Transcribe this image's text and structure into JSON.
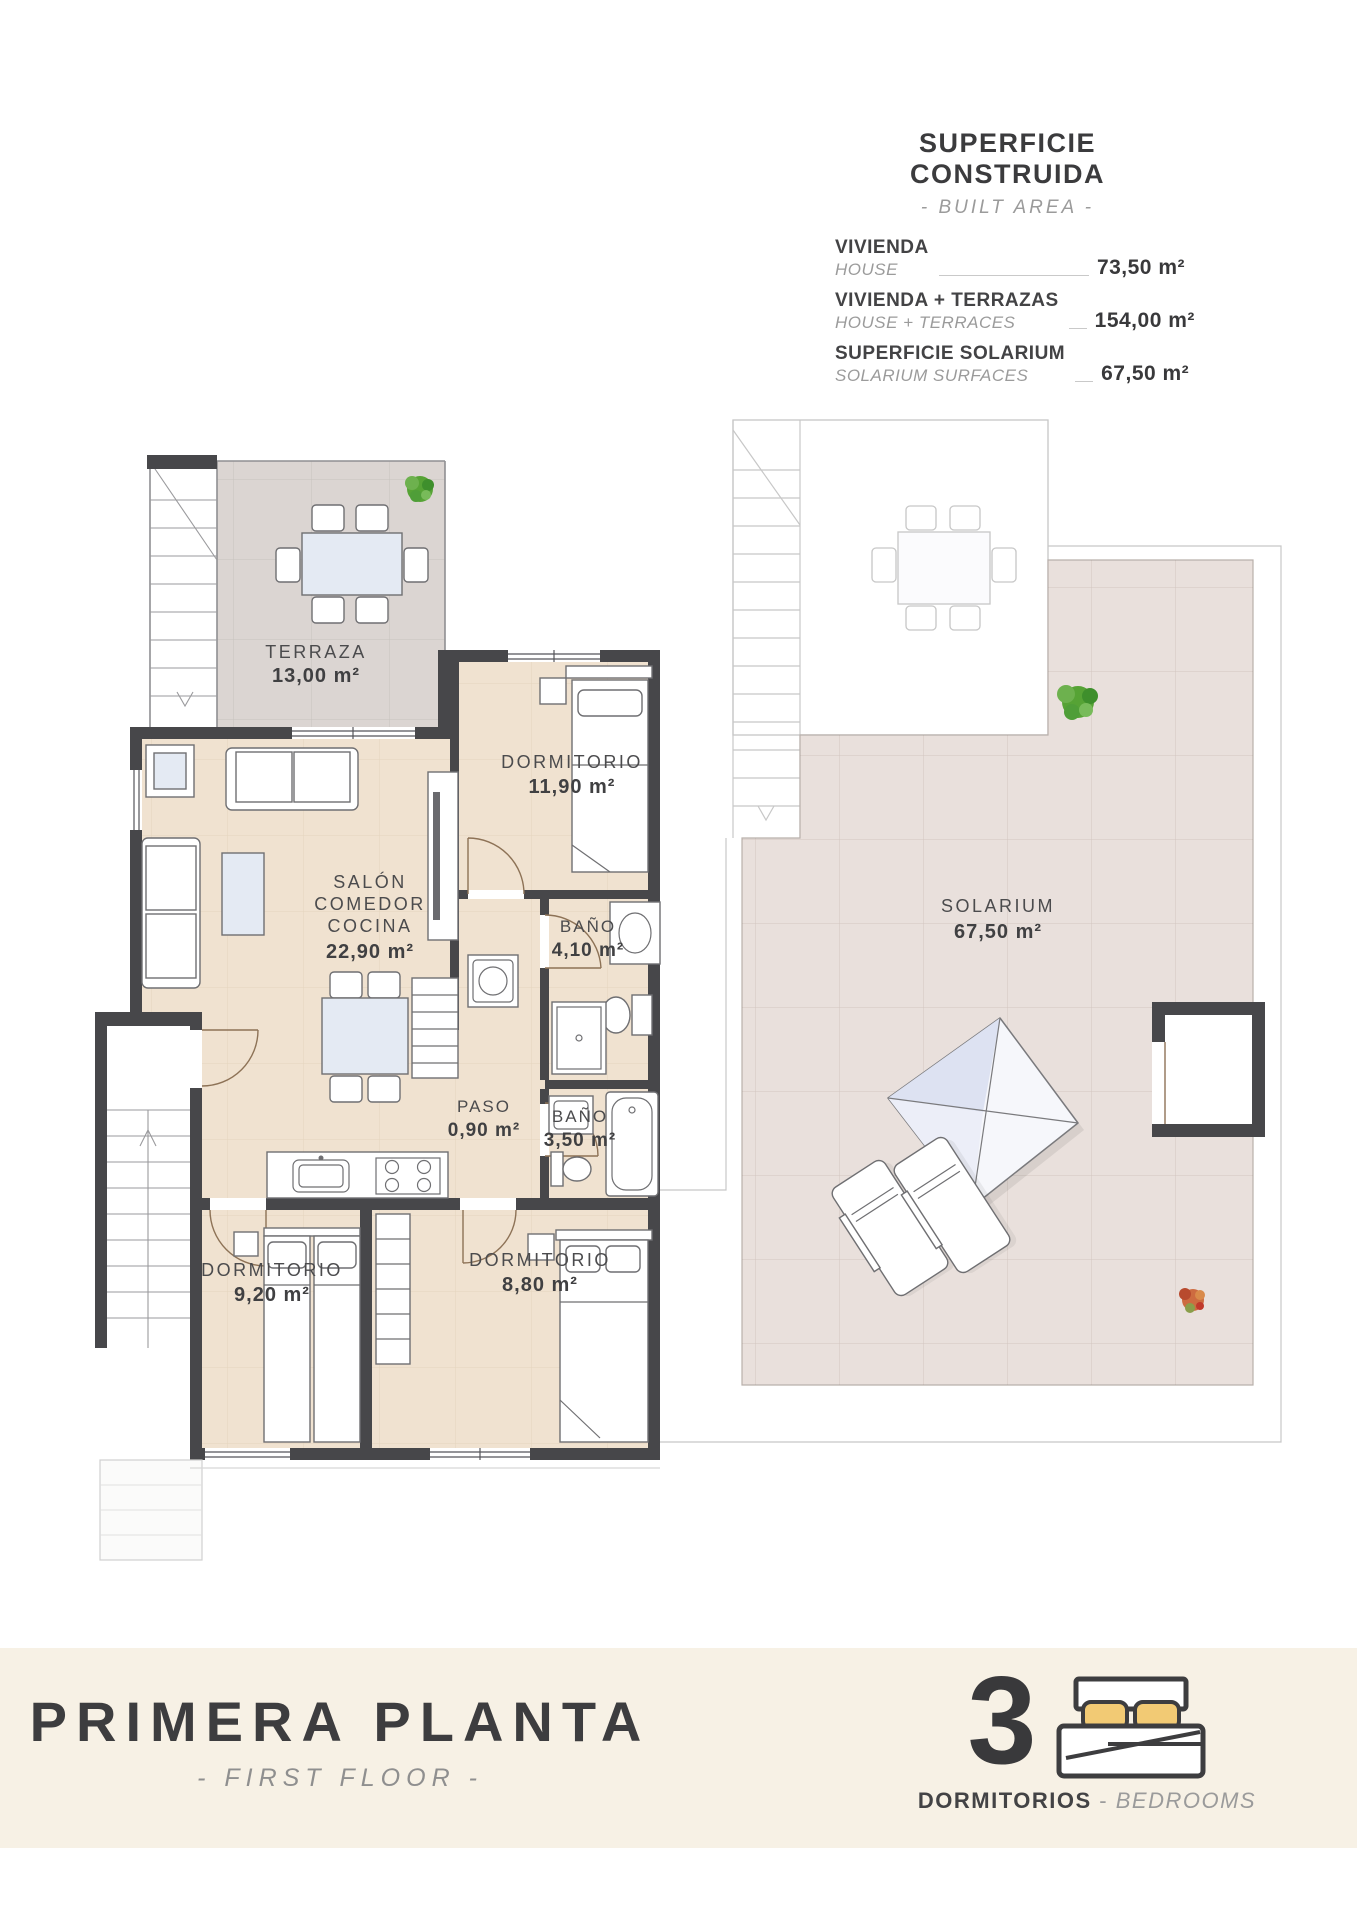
{
  "header": {
    "title": "SUPERFICIE CONSTRUIDA",
    "subtitle": "- BUILT AREA -",
    "rows": [
      {
        "label_es": "VIVIENDA",
        "label_en": "HOUSE",
        "value": "73,50 m²"
      },
      {
        "label_es": "VIVIENDA + TERRAZAS",
        "label_en": "HOUSE + TERRACES",
        "value": "154,00 m²"
      },
      {
        "label_es": "SUPERFICIE SOLARIUM",
        "label_en": "SOLARIUM SURFACES",
        "value": "67,50 m²"
      }
    ]
  },
  "floor_plan": {
    "terraza": {
      "name": "TERRAZA",
      "area": "13,00 m²"
    },
    "salon": {
      "line1": "SALÓN",
      "line2": "COMEDOR",
      "line3": "COCINA",
      "area": "22,90 m²"
    },
    "dormitorio1": {
      "name": "DORMITORIO",
      "area": "11,90 m²"
    },
    "bano1": {
      "name": "BAÑO",
      "area": "4,10 m²"
    },
    "paso": {
      "name": "PASO",
      "area": "0,90 m²"
    },
    "bano2": {
      "name": "BAÑO",
      "area": "3,50 m²"
    },
    "dormitorio2": {
      "name": "DORMITORIO",
      "area": "9,20 m²"
    },
    "dormitorio3": {
      "name": "DORMITORIO",
      "area": "8,80 m²"
    },
    "solarium": {
      "name": "SOLARIUM",
      "area": "67,50 m²"
    }
  },
  "footer": {
    "title_es": "PRIMERA PLANTA",
    "title_en": "- FIRST FLOOR -",
    "bedrooms": {
      "count": "3",
      "label_es": "DORMITORIOS",
      "separator": "-",
      "label_en": "BEDROOMS"
    }
  },
  "icons": {
    "bedrooms": "bed-icon",
    "plants": [
      "green-plant-icon",
      "red-plant-icon"
    ],
    "stairs": "staircase-icon"
  },
  "colors": {
    "wall": "#47474a",
    "apartment_floor": "#f0e2d0",
    "terrace_floor": "#dbd5d2",
    "solarium_floor": "#e9e0dc",
    "band_background": "#f7f1e5",
    "pillow_yellow": "#f2ca74",
    "plant_green": "#56a335",
    "plant_red": "#cd6b40",
    "text_dark": "#3b3b3d",
    "text_gray": "#9b9b9b"
  }
}
